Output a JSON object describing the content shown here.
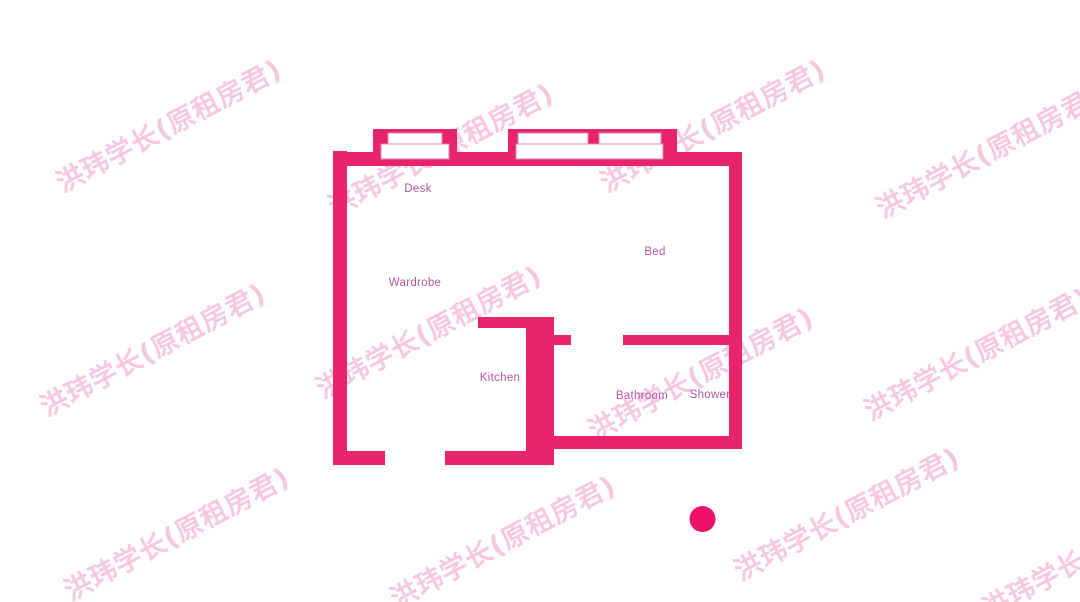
{
  "watermark": {
    "text": "洪玮学长(原租房君)"
  },
  "floorplan": {
    "labels": {
      "desk": "Desk",
      "wardrobe": "Wardrobe",
      "bed": "Bed",
      "kitchen": "Kitchen",
      "bathroom": "Bathroom",
      "shower": "Shower"
    }
  },
  "colors": {
    "wall": "#e9246b",
    "line": "#c express5ba0",
    "label": "#b157a0",
    "watermark": "rgba(226,74,148,0.30)",
    "dot": "#ed1168",
    "window_border": "#d886b4"
  }
}
